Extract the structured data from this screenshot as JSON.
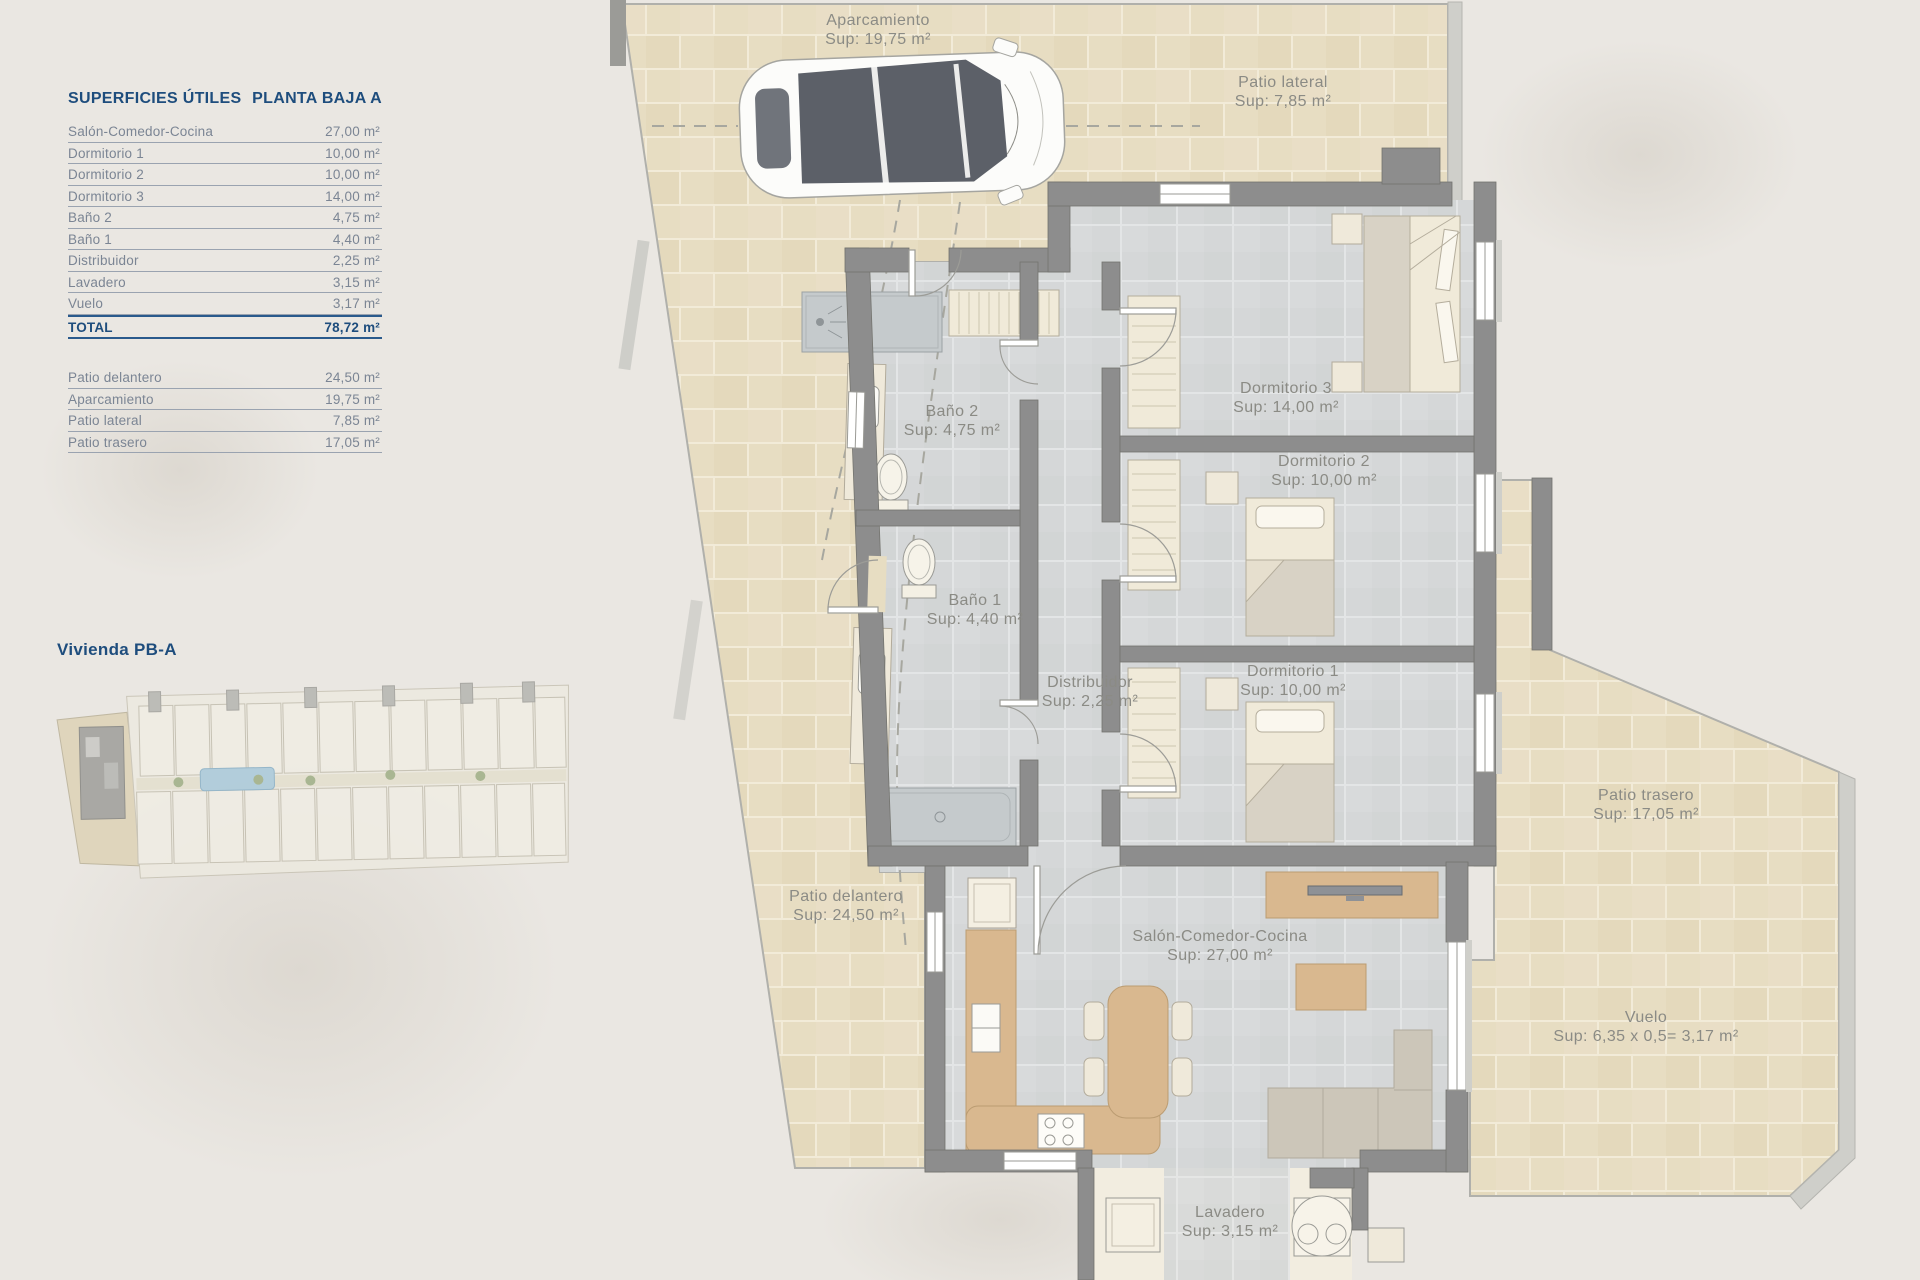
{
  "table": {
    "title_left": "SUPERFICIES ÚTILES",
    "title_right": "PLANTA BAJA A",
    "rows": [
      {
        "label": "Salón-Comedor-Cocina",
        "value": "27,00 m²"
      },
      {
        "label": "Dormitorio 1",
        "value": "10,00 m²"
      },
      {
        "label": "Dormitorio 2",
        "value": "10,00 m²"
      },
      {
        "label": "Dormitorio 3",
        "value": "14,00 m²"
      },
      {
        "label": "Baño 2",
        "value": "4,75 m²"
      },
      {
        "label": "Baño 1",
        "value": "4,40 m²"
      },
      {
        "label": "Distribuidor",
        "value": "2,25 m²"
      },
      {
        "label": "Lavadero",
        "value": "3,15 m²"
      },
      {
        "label": "Vuelo",
        "value": "3,17 m²"
      }
    ],
    "total": {
      "label": "TOTAL",
      "value": "78,72 m²"
    },
    "outdoor_rows": [
      {
        "label": "Patio delantero",
        "value": "24,50 m²"
      },
      {
        "label": "Aparcamiento",
        "value": "19,75 m²"
      },
      {
        "label": "Patio lateral",
        "value": "7,85 m²"
      },
      {
        "label": "Patio trasero",
        "value": "17,05 m²"
      }
    ]
  },
  "site_plan": {
    "title": "Vivienda PB-A"
  },
  "plan": {
    "rooms": [
      {
        "id": "aparcamiento",
        "name": "Aparcamiento",
        "sup": "Sup: 19,75 m²"
      },
      {
        "id": "patio-lateral",
        "name": "Patio lateral",
        "sup": "Sup: 7,85 m²"
      },
      {
        "id": "dormitorio3",
        "name": "Dormitorio 3",
        "sup": "Sup: 14,00 m²"
      },
      {
        "id": "bano2",
        "name": "Baño 2",
        "sup": "Sup: 4,75 m²"
      },
      {
        "id": "dormitorio2",
        "name": "Dormitorio 2",
        "sup": "Sup: 10,00 m²"
      },
      {
        "id": "bano1",
        "name": "Baño 1",
        "sup": "Sup: 4,40 m²"
      },
      {
        "id": "distribuidor",
        "name": "Distribuidor",
        "sup": "Sup: 2,25 m²"
      },
      {
        "id": "dormitorio1",
        "name": "Dormitorio 1",
        "sup": "Sup: 10,00 m²"
      },
      {
        "id": "patio-trasero",
        "name": "Patio trasero",
        "sup": "Sup: 17,05 m²"
      },
      {
        "id": "patio-delantero",
        "name": "Patio delantero",
        "sup": "Sup: 24,50 m²"
      },
      {
        "id": "salon",
        "name": "Salón-Comedor-Cocina",
        "sup": "Sup: 27,00 m²"
      },
      {
        "id": "vuelo",
        "name": "Vuelo",
        "sup": "Sup: 6,35 x 0,5= 3,17 m²"
      },
      {
        "id": "lavadero",
        "name": "Lavadero",
        "sup": "Sup: 3,15 m²"
      }
    ]
  },
  "colors": {
    "accent_navy": "#1e4d7d",
    "table_text": "#7b8594",
    "outdoor_tile": "#e7ddc2",
    "indoor_tile": "#d5d7d8",
    "wall": "#8d8d8d",
    "label_gray": "#8b8b85",
    "wood": "#d9b88f"
  }
}
